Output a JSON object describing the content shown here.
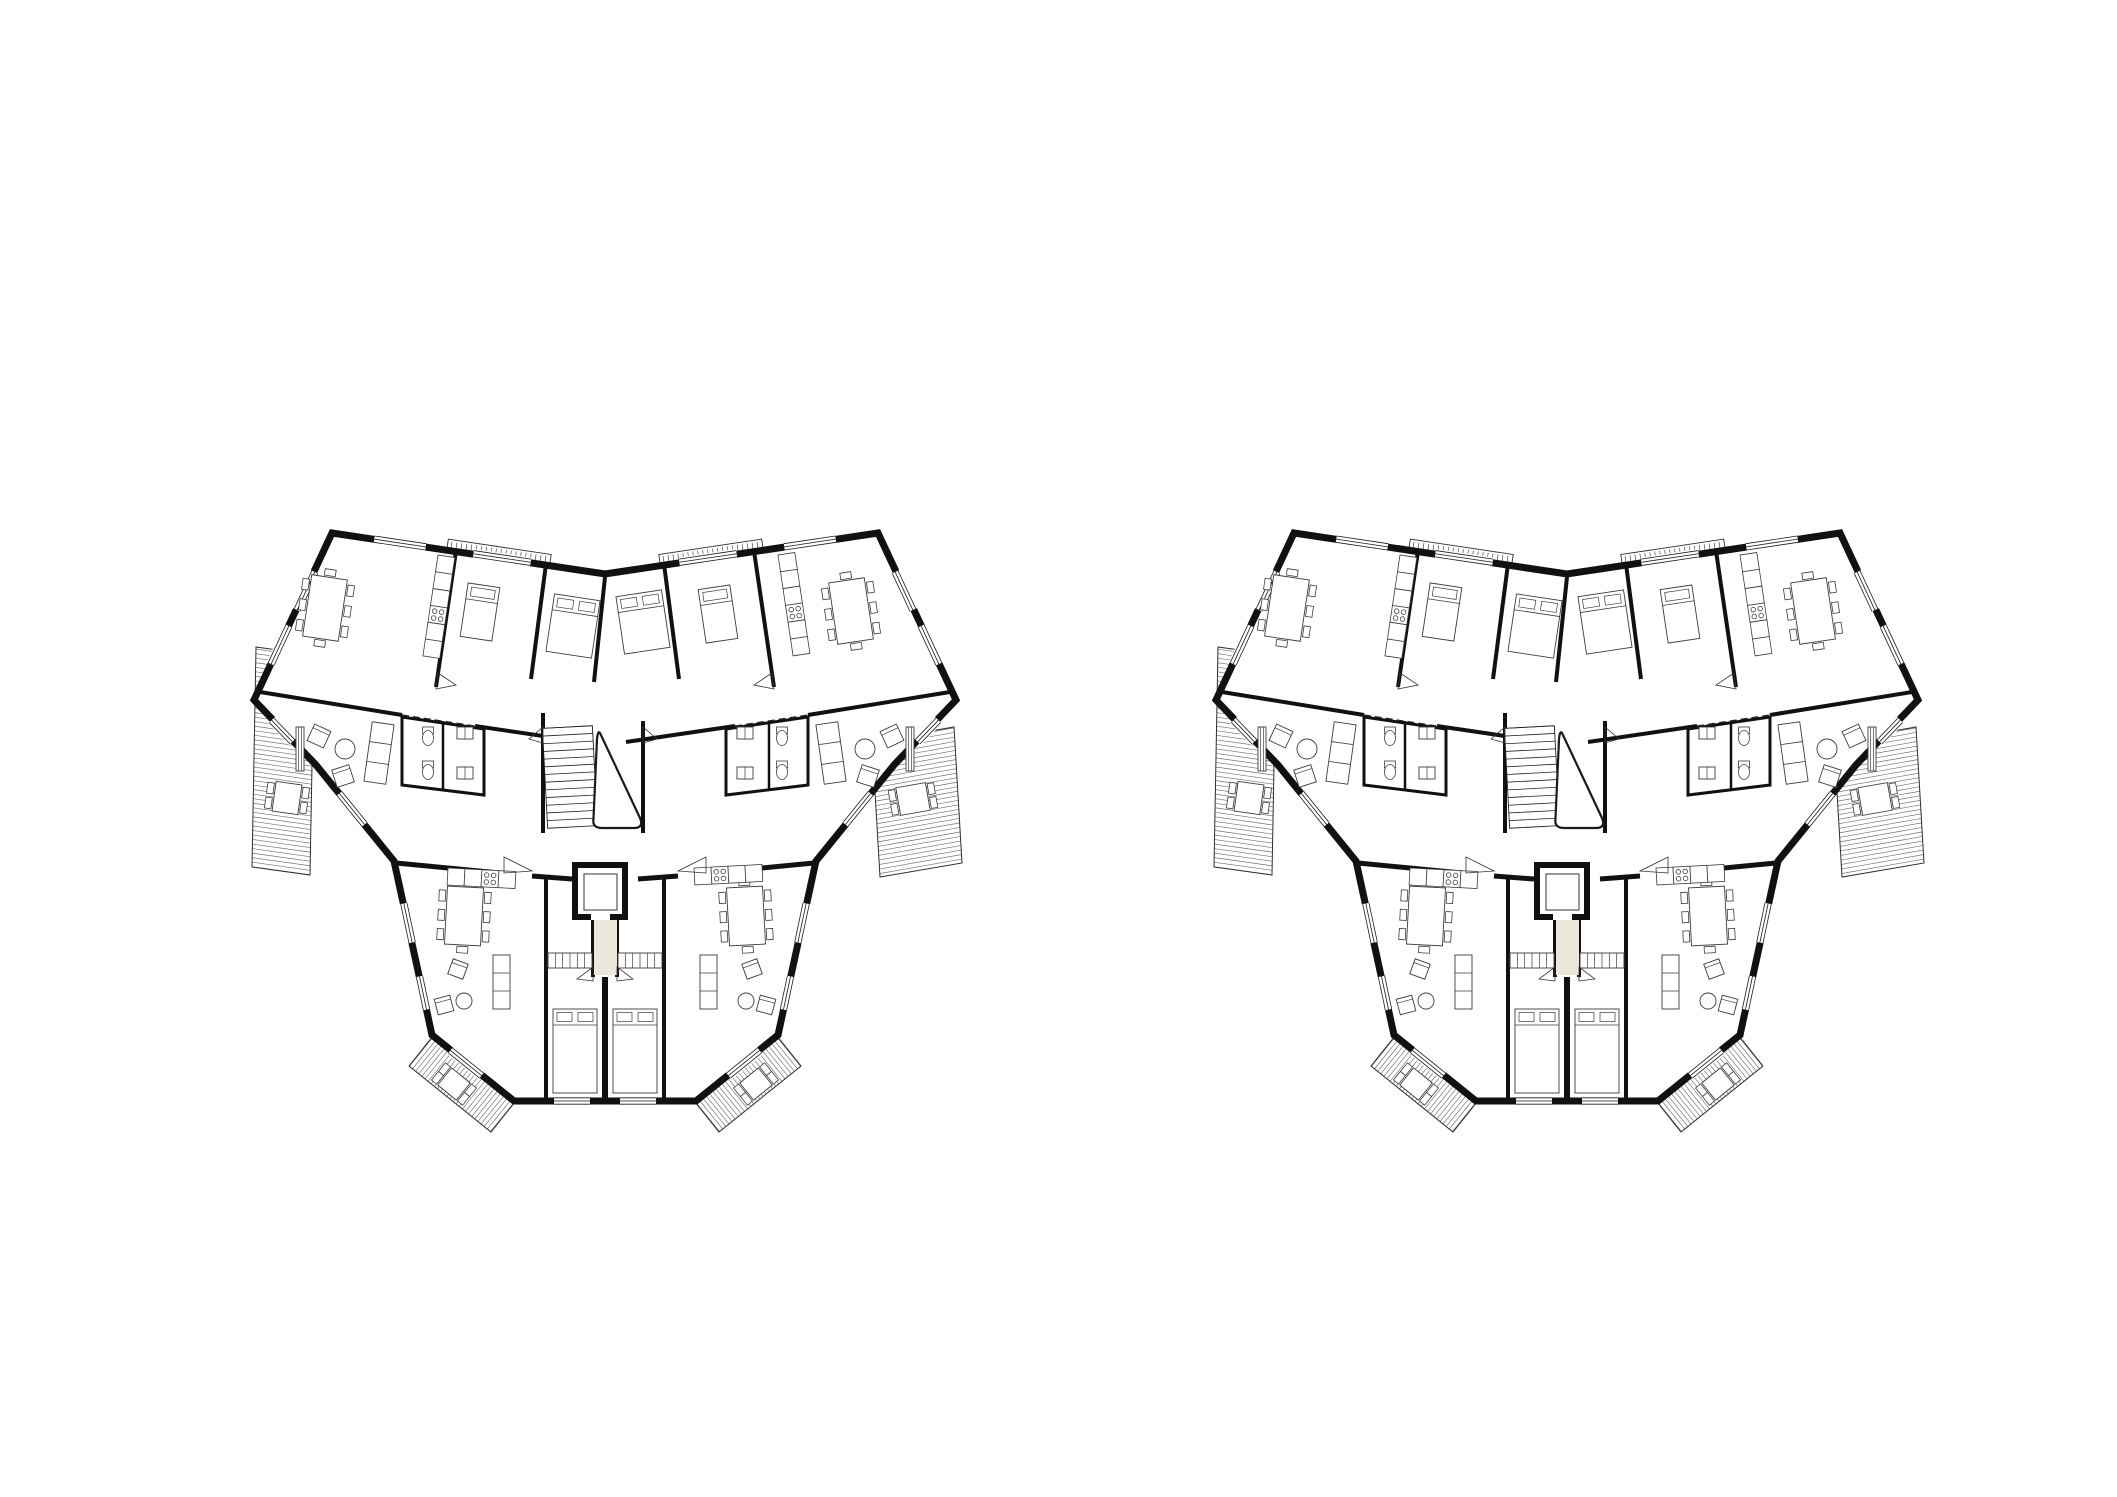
{
  "canvas": {
    "width": 2117,
    "height": 1497,
    "background": "#ffffff"
  },
  "colors": {
    "wall": "#111111",
    "line": "#2e2e2e",
    "hatch": "#6f6f6f",
    "furniture": "#3c3c3c",
    "window_line": "#1a1a1a",
    "corridor_fill": "#ece7db",
    "background": "#ffffff"
  },
  "plans": [
    {
      "name": "floor-plan-left",
      "x": 250,
      "y": 527
    },
    {
      "name": "floor-plan-right",
      "x": 1212,
      "y": 527
    }
  ],
  "plan_geometry": {
    "outline": "M82,6 L355,47 L628,6 L706,173 L644,238 L566,334 L528,508 L446,574 L264,574 L182,508 L144,334 L66,238 L4,173 Z",
    "terraces": [
      {
        "name": "terrace-left",
        "points": [
          [
            6,
            120
          ],
          [
            64,
            128
          ],
          [
            60,
            348
          ],
          [
            2,
            340
          ]
        ],
        "hatch_angle": 8,
        "step": 4.5
      },
      {
        "name": "terrace-right",
        "points": [
          [
            622,
            214
          ],
          [
            704,
            200
          ],
          [
            712,
            336
          ],
          [
            630,
            350
          ]
        ],
        "hatch_angle": -10,
        "step": 4.5
      },
      {
        "name": "balcony-bottom-left",
        "points": [
          [
            183,
            509
          ],
          [
            265,
            575
          ],
          [
            241,
            605
          ],
          [
            159,
            539
          ]
        ],
        "hatch_angle": -51,
        "step": 4
      },
      {
        "name": "balcony-bottom-right",
        "points": [
          [
            527,
            509
          ],
          [
            445,
            575
          ],
          [
            469,
            605
          ],
          [
            551,
            539
          ]
        ],
        "hatch_angle": 51,
        "step": 4
      }
    ],
    "railings": [
      {
        "name": "balcony-rail-top-left",
        "x": 196,
        "y": 12,
        "len": 104,
        "h": 16,
        "angle": 8.5,
        "pivot": "left"
      },
      {
        "name": "balcony-rail-top-right",
        "x": 410,
        "y": 12,
        "len": 104,
        "h": 16,
        "angle": -8.5,
        "pivot": "right"
      }
    ],
    "windows": [
      {
        "cx": 150,
        "cy": 16,
        "len": 52,
        "a": 8.5
      },
      {
        "cx": 252,
        "cy": 31,
        "len": 58,
        "a": 8.5
      },
      {
        "cx": 458,
        "cy": 31,
        "len": 58,
        "a": -8.5
      },
      {
        "cx": 560,
        "cy": 16,
        "len": 52,
        "a": -8.5
      },
      {
        "cx": 56,
        "cy": 64,
        "len": 42,
        "a": -65
      },
      {
        "cx": 30,
        "cy": 118,
        "len": 42,
        "a": -65
      },
      {
        "cx": 654,
        "cy": 64,
        "len": 42,
        "a": 65
      },
      {
        "cx": 680,
        "cy": 118,
        "len": 42,
        "a": 65
      },
      {
        "cx": 32,
        "cy": 204,
        "len": 30,
        "a": 46
      },
      {
        "cx": 678,
        "cy": 204,
        "len": 30,
        "a": -46
      },
      {
        "cx": 102,
        "cy": 282,
        "len": 40,
        "a": 51
      },
      {
        "cx": 608,
        "cy": 282,
        "len": 40,
        "a": -51
      },
      {
        "cx": 158,
        "cy": 396,
        "len": 40,
        "a": 78
      },
      {
        "cx": 552,
        "cy": 396,
        "len": 40,
        "a": -78
      },
      {
        "cx": 173,
        "cy": 466,
        "len": 34,
        "a": 78
      },
      {
        "cx": 537,
        "cy": 466,
        "len": 34,
        "a": -78
      },
      {
        "cx": 216,
        "cy": 536,
        "len": 40,
        "a": 39
      },
      {
        "cx": 494,
        "cy": 536,
        "len": 40,
        "a": -39
      },
      {
        "cx": 322,
        "cy": 574,
        "len": 36,
        "a": 0
      },
      {
        "cx": 388,
        "cy": 574,
        "len": 36,
        "a": 0
      }
    ],
    "walls": [
      {
        "d": "M10,165 L152,188",
        "w": 4
      },
      {
        "d": "M225,199 L334,215",
        "w": 4
      },
      {
        "d": "M376,215 L485,199",
        "w": 4
      },
      {
        "d": "M558,188 L700,165",
        "w": 4
      },
      {
        "d": "M206,24 L186,160",
        "w": 4
      },
      {
        "d": "M296,37 L281,152",
        "w": 4
      },
      {
        "d": "M355,50 L344,155",
        "w": 4
      },
      {
        "d": "M504,24 L524,160",
        "w": 4
      },
      {
        "d": "M414,37 L429,152",
        "w": 4
      },
      {
        "d": "M293,186 L293,306",
        "w": 4
      },
      {
        "d": "M393,194 L393,306",
        "w": 4
      },
      {
        "d": "M146,336 L250,346",
        "w": 5
      },
      {
        "d": "M282,349 L322,352",
        "w": 5
      },
      {
        "d": "M388,352 L428,349",
        "w": 5
      },
      {
        "d": "M460,346 L564,336",
        "w": 5
      },
      {
        "d": "M343,392 L343,450",
        "w": 4
      },
      {
        "d": "M367,392 L367,450",
        "w": 4
      },
      {
        "d": "M355,450 L355,572",
        "w": 6
      },
      {
        "d": "M296,352 L296,572",
        "w": 4
      },
      {
        "d": "M414,352 L414,572",
        "w": 4
      },
      {
        "d": "M152,190 L234,202 L234,268 L152,258 Z",
        "w": 3
      },
      {
        "d": "M193,194 L193,264",
        "w": 2.5
      },
      {
        "d": "M476,202 L558,190 L558,258 L476,268 Z",
        "w": 3
      },
      {
        "d": "M519,194 L519,264",
        "w": 2.5
      }
    ],
    "dashed": [
      {
        "d": "M152,188 L225,199"
      },
      {
        "d": "M485,199 L558,188"
      }
    ],
    "stair": {
      "rail_x": [
        295,
        345
      ],
      "y0": 200,
      "y1": 300,
      "step": 7.7,
      "angle": -3,
      "cx": 320,
      "cy": 250,
      "void": "M350,206 L390,291 Q394,301 384,301 L352,301 Q342,301 343.5,291.5 L347,212 Q348,203 350,206 Z"
    },
    "elevator": {
      "x": 325,
      "y": 338,
      "w": 50,
      "h": 52,
      "cab": [
        334,
        347,
        33,
        36
      ],
      "door": [
        341,
        386,
        19,
        7
      ]
    },
    "corridor": {
      "x": 344,
      "y": 393,
      "w": 23,
      "h": 55
    },
    "furniture": {
      "tables": [
        {
          "x": 57,
          "y": 50,
          "w": 36,
          "h": 62,
          "a": 8.5
        },
        {
          "x": 583,
          "y": 53,
          "w": 36,
          "h": 62,
          "a": -8.5
        },
        {
          "x": 196,
          "y": 360,
          "w": 36,
          "h": 58,
          "a": 3
        },
        {
          "x": 478,
          "y": 360,
          "w": 36,
          "h": 58,
          "a": -3
        }
      ],
      "terrace_tables": [
        {
          "x": 24,
          "y": 256,
          "w": 26,
          "h": 30,
          "a": 8,
          "chairs": 2
        },
        {
          "x": 648,
          "y": 258,
          "w": 30,
          "h": 28,
          "a": -10,
          "chairs": 2
        },
        {
          "x": 192,
          "y": 546,
          "w": 24,
          "h": 22,
          "a": 39,
          "chairs": 2
        },
        {
          "x": 494,
          "y": 546,
          "w": 24,
          "h": 22,
          "a": -39,
          "chairs": 2
        }
      ],
      "beds": [
        {
          "x": 214,
          "y": 58,
          "w": 32,
          "h": 54,
          "a": 8.5
        },
        {
          "x": 300,
          "y": 70,
          "w": 46,
          "h": 58,
          "a": 8.5
        },
        {
          "x": 370,
          "y": 66,
          "w": 46,
          "h": 58,
          "a": -8.5
        },
        {
          "x": 452,
          "y": 60,
          "w": 32,
          "h": 54,
          "a": -8.5
        },
        {
          "x": 303,
          "y": 482,
          "w": 44,
          "h": 84,
          "a": 0
        },
        {
          "x": 363,
          "y": 482,
          "w": 44,
          "h": 84,
          "a": 0
        }
      ],
      "kitchens": [
        {
          "x": 188,
          "y": 28,
          "n": 6,
          "a": 8.5,
          "hob": 3,
          "horiz": false
        },
        {
          "x": 528,
          "y": 28,
          "n": 6,
          "a": -8.5,
          "hob": 3,
          "horiz": false
        },
        {
          "x": 198,
          "y": 341,
          "n": 4,
          "a": 3,
          "hob": 2,
          "horiz": true
        },
        {
          "x": 444,
          "y": 341,
          "n": 4,
          "a": -3,
          "hob": 1,
          "horiz": true
        }
      ],
      "sofas": [
        {
          "x": 118,
          "y": 196,
          "w": 22,
          "h": 60,
          "a": 8,
          "c": 3
        },
        {
          "x": 570,
          "y": 196,
          "w": 22,
          "h": 60,
          "a": -8,
          "c": 3
        },
        {
          "x": 243,
          "y": 428,
          "w": 17,
          "h": 54,
          "a": 0,
          "c": 3
        },
        {
          "x": 450,
          "y": 428,
          "w": 17,
          "h": 54,
          "a": 0,
          "c": 3
        }
      ],
      "armchairs": [
        {
          "x": 60,
          "y": 200,
          "s": 18,
          "a": 25
        },
        {
          "x": 84,
          "y": 240,
          "s": 18,
          "a": -18
        },
        {
          "x": 633,
          "y": 200,
          "s": 18,
          "a": -25
        },
        {
          "x": 609,
          "y": 240,
          "s": 18,
          "a": 18
        },
        {
          "x": 200,
          "y": 434,
          "s": 16,
          "a": 20
        },
        {
          "x": 186,
          "y": 470,
          "s": 16,
          "a": -15
        },
        {
          "x": 494,
          "y": 434,
          "s": 16,
          "a": -20
        },
        {
          "x": 508,
          "y": 470,
          "s": 16,
          "a": 15
        }
      ],
      "round_tables": [
        {
          "cx": 95,
          "cy": 222,
          "r": 10
        },
        {
          "cx": 615,
          "cy": 222,
          "r": 10
        },
        {
          "cx": 214,
          "cy": 474,
          "r": 8
        },
        {
          "cx": 496,
          "cy": 474,
          "r": 8
        }
      ],
      "toilets": [
        {
          "x": 178,
          "y": 210,
          "a": 0
        },
        {
          "x": 178,
          "y": 244,
          "a": 0
        },
        {
          "x": 532,
          "y": 210,
          "a": 0
        },
        {
          "x": 532,
          "y": 244,
          "a": 0
        }
      ],
      "wardrobes": [
        {
          "x": 298,
          "y": 426,
          "w": 44,
          "h": 15,
          "ticks": 5
        },
        {
          "x": 368,
          "y": 426,
          "w": 44,
          "h": 15,
          "ticks": 5
        },
        {
          "x": 46,
          "y": 200,
          "w": 8,
          "h": 44,
          "ticks": 2
        },
        {
          "x": 656,
          "y": 200,
          "w": 8,
          "h": 44,
          "ticks": 2
        },
        {
          "x": 207,
          "y": 200,
          "w": 16,
          "h": 12,
          "ticks": 1
        },
        {
          "x": 207,
          "y": 240,
          "w": 16,
          "h": 12,
          "ticks": 1
        },
        {
          "x": 487,
          "y": 200,
          "w": 16,
          "h": 12,
          "ticks": 1
        },
        {
          "x": 487,
          "y": 240,
          "w": 16,
          "h": 12,
          "ticks": 1
        }
      ]
    },
    "swings": [
      [
        [
          254,
          346
        ],
        [
          282,
          344
        ],
        [
          254,
          330
        ]
      ],
      [
        [
          456,
          346
        ],
        [
          428,
          344
        ],
        [
          456,
          330
        ]
      ],
      [
        [
          293,
          216
        ],
        [
          279,
          212
        ],
        [
          293,
          200
        ]
      ],
      [
        [
          393,
          216
        ],
        [
          407,
          212
        ],
        [
          393,
          200
        ]
      ],
      [
        [
          186,
          162
        ],
        [
          206,
          158
        ],
        [
          188,
          146
        ]
      ],
      [
        [
          524,
          162
        ],
        [
          504,
          158
        ],
        [
          522,
          146
        ]
      ],
      [
        [
          343,
          454
        ],
        [
          327,
          452
        ],
        [
          343,
          440
        ]
      ],
      [
        [
          367,
          454
        ],
        [
          383,
          452
        ],
        [
          367,
          440
        ]
      ]
    ]
  }
}
